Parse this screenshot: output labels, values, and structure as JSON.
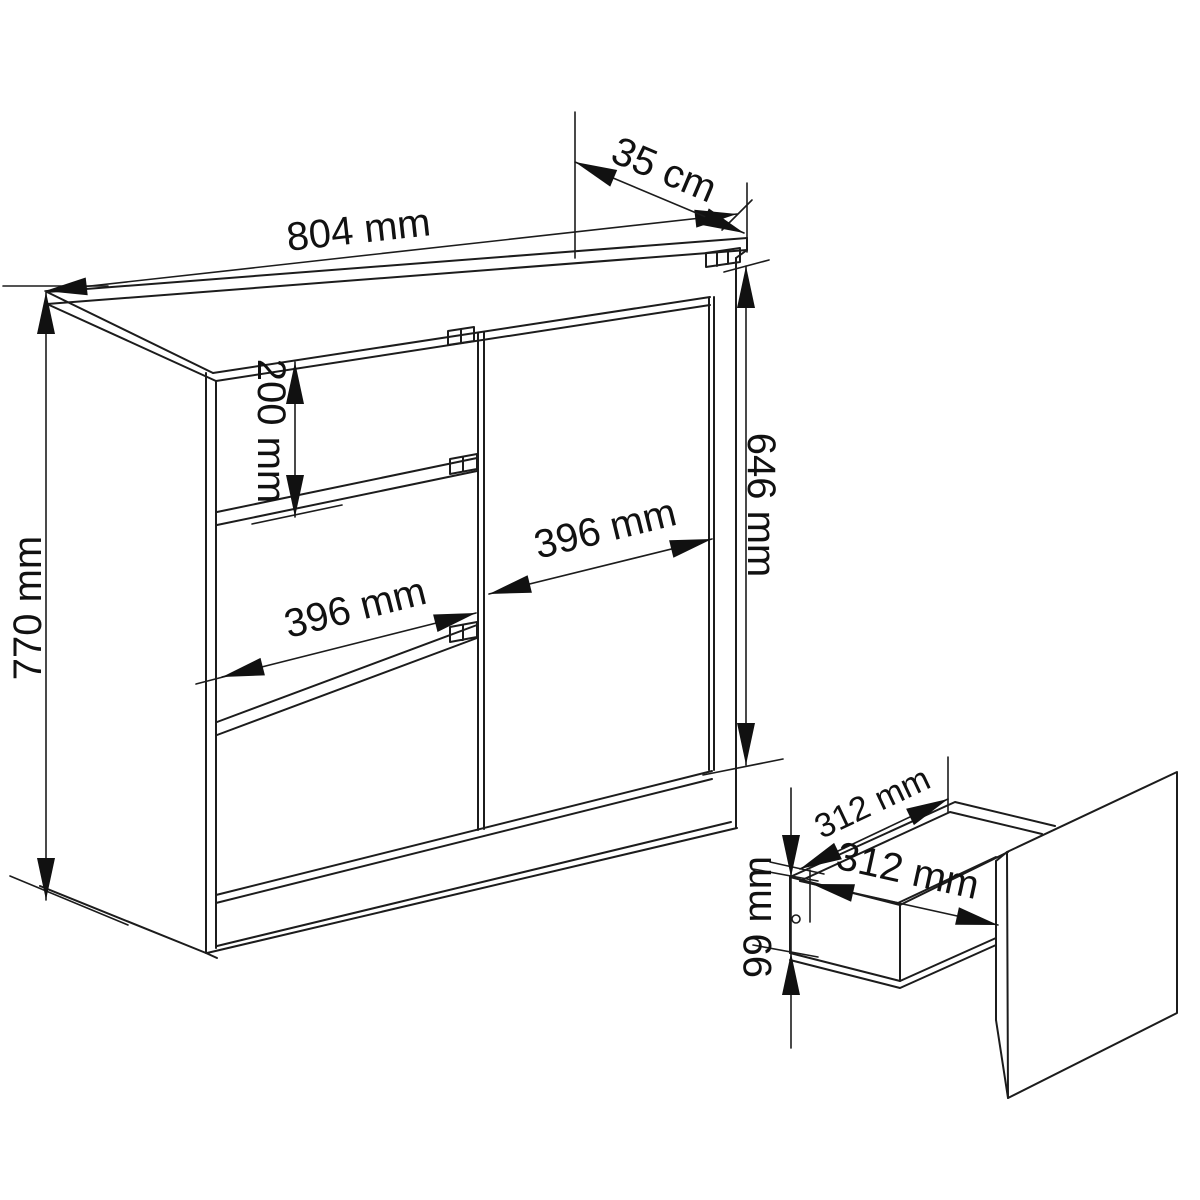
{
  "document": {
    "kind": "furniture-technical-dimension-diagram",
    "background_color": "#ffffff",
    "line_color": "#1c1c1c",
    "views": [
      "cabinet-perspective",
      "drawer-detail-perspective"
    ]
  },
  "labels": {
    "dim_width": "804 mm",
    "dim_depth": "35 cm",
    "dim_height": "770 mm",
    "dim_top_drawer_height": "200 mm",
    "dim_door_height": "646 mm",
    "dim_door_width": "396 mm",
    "dim_drawer_front_width": "396 mm",
    "dim_drawer_inner_depth": "312 mm",
    "dim_drawer_inner_width": "312 mm",
    "dim_drawer_inner_height": "99 mm"
  },
  "chart_data": {
    "type": "table",
    "title": "Chest of drawers dimensions",
    "rows": [
      {
        "part": "cabinet",
        "dimension": "width",
        "value": "804 mm"
      },
      {
        "part": "cabinet",
        "dimension": "depth",
        "value": "35 cm"
      },
      {
        "part": "cabinet",
        "dimension": "height",
        "value": "770 mm"
      },
      {
        "part": "top drawer front",
        "dimension": "height",
        "value": "200 mm"
      },
      {
        "part": "door",
        "dimension": "height",
        "value": "646 mm"
      },
      {
        "part": "door",
        "dimension": "width",
        "value": "396 mm"
      },
      {
        "part": "drawer front",
        "dimension": "width",
        "value": "396 mm"
      },
      {
        "part": "drawer box",
        "dimension": "inner depth",
        "value": "312 mm"
      },
      {
        "part": "drawer box",
        "dimension": "inner width",
        "value": "312 mm"
      },
      {
        "part": "drawer box",
        "dimension": "inner height",
        "value": "99 mm"
      }
    ]
  }
}
